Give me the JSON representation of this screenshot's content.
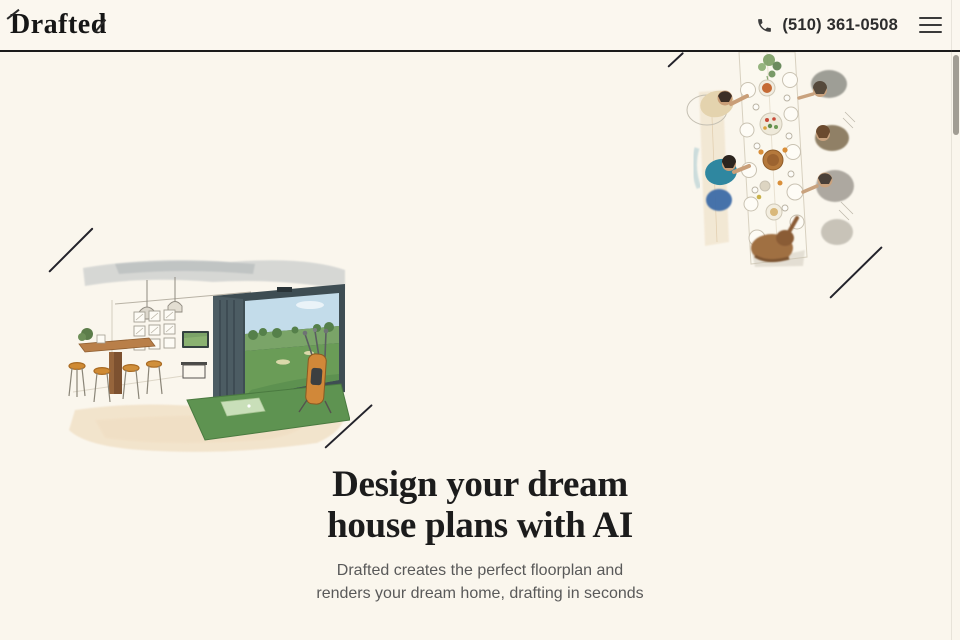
{
  "header": {
    "logo": "Drafted",
    "phone": "(510) 361-0508",
    "icons": {
      "phone": "phone-icon",
      "menu": "hamburger-menu-icon"
    }
  },
  "hero": {
    "heading_line1": "Design your dream",
    "heading_line2": "house plans with AI",
    "subtext_line1": "Drafted creates the perfect floorplan and",
    "subtext_line2": "renders your dream home, drafting in seconds"
  },
  "illustrations": {
    "left": "golf-simulator-room-watercolor",
    "top_right": "family-dinner-table-overhead-watercolor",
    "accents": "diagonal-accent-lines"
  },
  "colors": {
    "background": "#faf6ed",
    "header_rule": "#1b1b1b",
    "ink": "#1c1c1c",
    "subtext": "#595959",
    "turf_green": "#5e9351",
    "stool_orange": "#cf8a33",
    "teal_shirt": "#2f87a0",
    "accent_line": "#23232b"
  }
}
